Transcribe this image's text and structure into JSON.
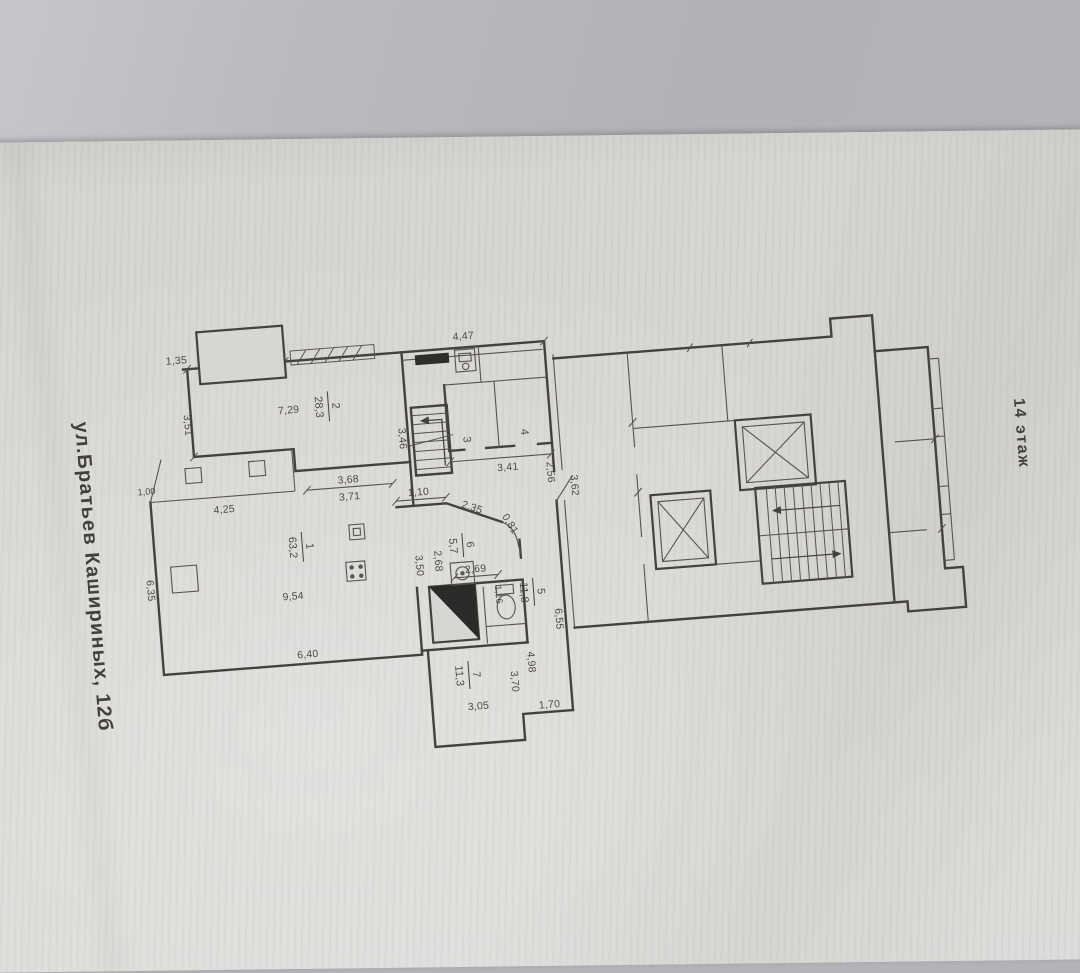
{
  "photo": {
    "address_label": "ул.Братьев Кашириных, 12б",
    "floor_label": "14 этаж"
  },
  "rooms": {
    "r1": {
      "num": "1",
      "area": "63,2"
    },
    "r2": {
      "num": "2",
      "area": "28,3"
    },
    "r3": {
      "num": "3"
    },
    "r4": {
      "num": "4"
    },
    "r5": {
      "num": "5",
      "area": "11,8"
    },
    "r6": {
      "num": "6",
      "area": "5,7"
    },
    "r7": {
      "num": "7",
      "area": "11,3"
    }
  },
  "dims": {
    "d1_35": "1,35",
    "d4_47": "4,47",
    "d3_51": "3,51",
    "d7_29": "7,29",
    "d3_46": "3,46",
    "d3_68": "3,68",
    "d3_71": "3,71",
    "d3_41": "3,41",
    "d2_56": "2,56",
    "d3_62": "3,62",
    "d1_10": "1,10",
    "d2_35": "2,35",
    "d0_81": "0,81",
    "d4_25": "4,25",
    "d1_00": "1,00",
    "d6_35": "6,35",
    "d9_54": "9,54",
    "d6_40": "6,40",
    "d2_68": "2,68",
    "d3_50": "3,50",
    "d2_69": "2,69",
    "d1_16": "1,16",
    "d6_55": "6,55",
    "d4_98": "4,98",
    "d3_70": "3,70",
    "d3_05": "3,05",
    "d1_70": "1,70"
  }
}
